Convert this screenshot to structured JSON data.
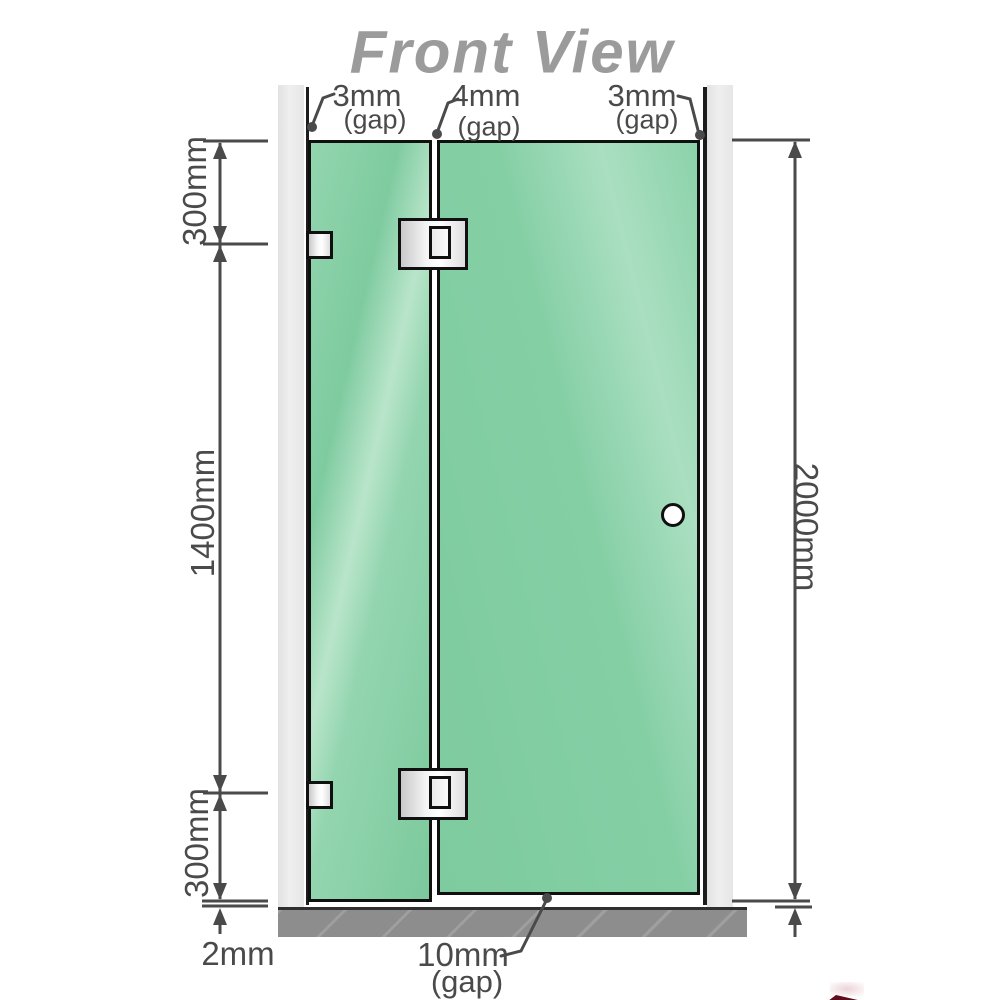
{
  "title": "Front View",
  "dimensions": {
    "gap_left": {
      "value": "3mm",
      "suffix": "(gap)"
    },
    "gap_middle": {
      "value": "4mm",
      "suffix": "(gap)"
    },
    "gap_right": {
      "value": "3mm",
      "suffix": "(gap)"
    },
    "panel_top": "300mm",
    "panel_middle": "1400mm",
    "panel_bottom": "300mm",
    "total_height": "2000mm",
    "floor_gap": "2mm",
    "door_floor_gap": {
      "value": "10mm",
      "suffix": "(gap)"
    }
  },
  "colors": {
    "glass_green": "#84cfa4",
    "glass_highlight": "#b9e5ca",
    "wall_gray": "#e9e9e9",
    "floor_gray": "#8d8d8d",
    "dimension_line": "#4a4a4a",
    "title_gray": "#9b9b9b",
    "hardware_fill": "#f0f0f0",
    "outline_black": "#101010"
  }
}
